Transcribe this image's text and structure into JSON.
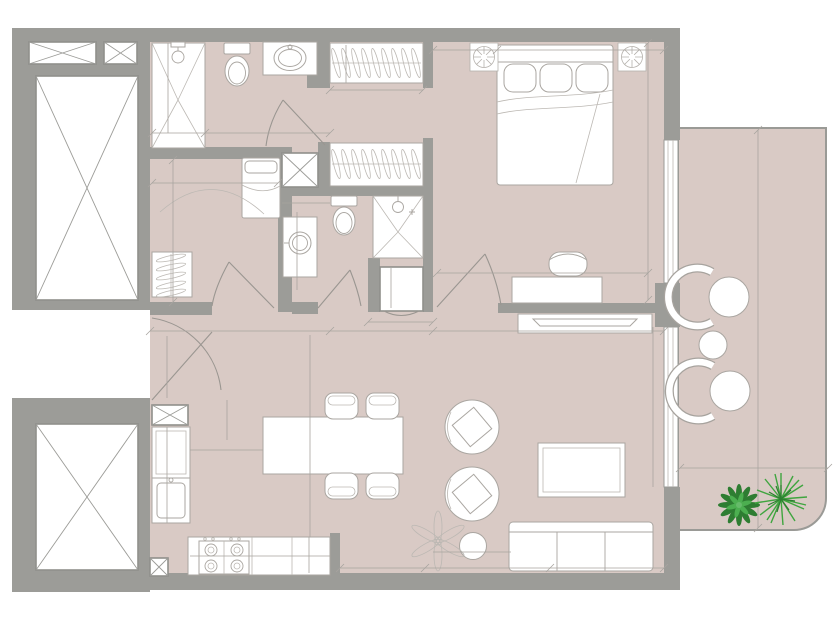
{
  "plan": {
    "type": "apartment floor plan",
    "rooms": {
      "bedroom": "BEDROOM",
      "kitchen": "KITCHEN",
      "living": "LIVING",
      "tnb_main": "T&B",
      "tnb_maid": "T&B",
      "maids_room_line1": "MAID'S",
      "maids_room_line2": "ROOM"
    },
    "dimensions": {
      "tnb_main_shower_len": "1600",
      "tnb_main_shower_wid": "800",
      "tnb_main_width": "1650",
      "wardrobe_depth": "600",
      "wardrobe_width": "1400",
      "bed_clearance": "1000",
      "bedroom_bed_wall": "2350",
      "bedroom_depth": "3850",
      "bedroom_desk_wall": "3350",
      "maids_bed_len": "1800",
      "maids_room_depth": "2150",
      "tnb_maid_entry": "500",
      "tnb_maid_len": "1600",
      "shaft_h": "650",
      "shaft_w": "650",
      "entry_width": "1700",
      "entry_door": "1250",
      "living_width": "5700",
      "island_gap": "700",
      "island_offset": "1010",
      "kitchen_depth": "3250",
      "counter_len": "1850",
      "counter_run": "2600",
      "counter_depth": "600",
      "clear_dining": "1250",
      "clear_sofa_side": "1800",
      "living_run": "4700",
      "sofa_len": "1650",
      "living_depth": "3850",
      "balcony_len": "5090",
      "balcony_depth": "1970"
    },
    "colors": {
      "floor": "#d9cac5",
      "wall": "#9c9c98",
      "outline": "#aaa6a1",
      "dim_text": "#8b8b87",
      "label_text": "#9d9893",
      "plant_dark": "#2e7d32",
      "plant_light": "#4caf50"
    }
  }
}
